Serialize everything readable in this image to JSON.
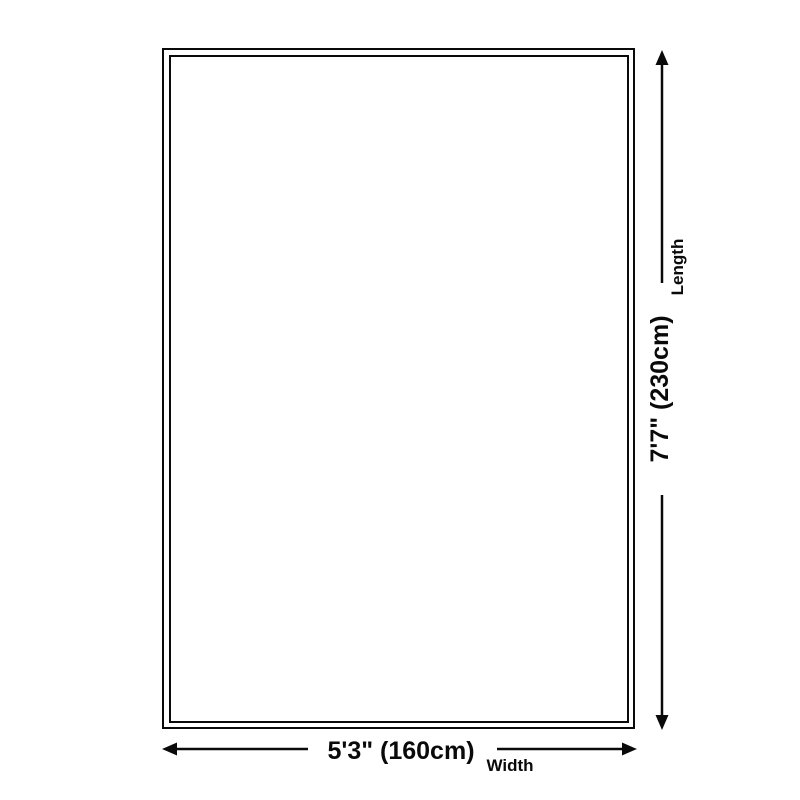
{
  "theme": {
    "ink": "#0a0a0a",
    "background": "#ffffff"
  },
  "diagram": {
    "width": {
      "value": "5'3\" (160cm)",
      "label": "Width"
    },
    "length": {
      "value": "7'7\" (230cm)",
      "label": "Length"
    }
  }
}
